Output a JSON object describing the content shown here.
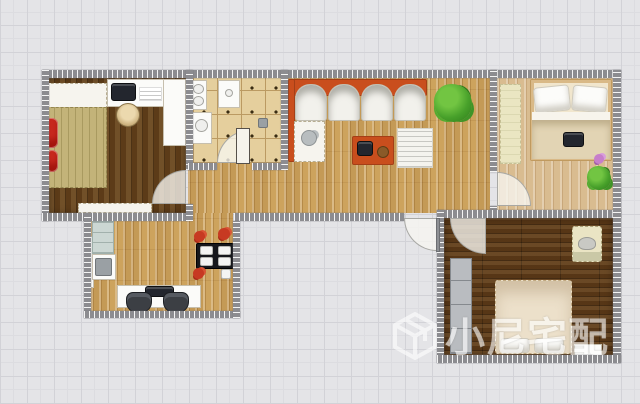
{
  "canvas": {
    "width": 640,
    "height": 404
  },
  "background": {
    "color": "#e4e4e7",
    "grid_color": "#d2d2d7",
    "grid_size_px": 27
  },
  "watermark": {
    "text": "小尼宅配",
    "logo": "cube-logo",
    "color": "#ffffff"
  },
  "colors": {
    "wall": "#8c8c90",
    "wood_floor_living": "#cda35d",
    "wood_floor_light_bedroom": "#d9bc90",
    "wood_floor_dark_bedroom": "#61401b",
    "bathroom_tile": "#e5cf9d",
    "sofa_accent_orange": "#c94e1d",
    "red_furniture": "#c8281e",
    "plant_green": "#47a02a"
  },
  "elements": [
    {
      "name": "bedroom-left-floor",
      "cls": "floor-dark-v",
      "r": [
        49,
        77,
        137,
        137
      ]
    },
    {
      "name": "living-room-floor",
      "cls": "floor-wood",
      "r": [
        188,
        77,
        302,
        136
      ]
    },
    {
      "name": "bathroom-floor",
      "cls": "floor-tile",
      "r": [
        193,
        77,
        88,
        86
      ]
    },
    {
      "name": "bedroom-right-floor",
      "cls": "floor-light-v",
      "r": [
        497,
        77,
        116,
        134
      ]
    },
    {
      "name": "dining-room-floor",
      "cls": "floor-wood",
      "r": [
        91,
        213,
        142,
        98
      ]
    },
    {
      "name": "bedroom-bottom-floor",
      "cls": "floor-dark-h",
      "r": [
        444,
        218,
        169,
        137
      ]
    },
    {
      "name": "left-bedroom-bedhead-mat",
      "cls": "white-stitch",
      "r": [
        46,
        83,
        61,
        26
      ]
    },
    {
      "name": "left-bedroom-bed",
      "cls": "bed-khaki",
      "r": [
        46,
        107,
        61,
        81
      ]
    },
    {
      "name": "left-bedroom-red-chair-1",
      "cls": "red-item",
      "r": [
        44,
        118,
        14,
        30
      ]
    },
    {
      "name": "left-bedroom-red-chair-2",
      "cls": "red-item",
      "r": [
        46,
        150,
        12,
        22
      ]
    },
    {
      "name": "left-bedroom-desk",
      "cls": "white-furn",
      "r": [
        107,
        79,
        58,
        28
      ]
    },
    {
      "name": "left-bedroom-computer",
      "cls": "dark-item",
      "r": [
        111,
        83,
        25,
        18
      ]
    },
    {
      "name": "left-bedroom-keyboard",
      "cls": "paper",
      "r": [
        139,
        87,
        23,
        14
      ]
    },
    {
      "name": "left-bedroom-wardrobe",
      "cls": "white-furn",
      "r": [
        163,
        79,
        23,
        67
      ]
    },
    {
      "name": "left-bedroom-stool",
      "cls": "stool",
      "r": [
        116,
        103,
        24,
        24
      ]
    },
    {
      "name": "left-bedroom-dresser",
      "cls": "white-stitch",
      "r": [
        78,
        203,
        74,
        10
      ]
    },
    {
      "name": "bathroom-vanity",
      "cls": "white-furn",
      "r": [
        191,
        80,
        16,
        30
      ]
    },
    {
      "name": "bathroom-vanity-bowl-1",
      "cls": "bowl",
      "r": [
        193,
        84,
        11,
        10
      ]
    },
    {
      "name": "bathroom-vanity-bowl-2",
      "cls": "bowl",
      "r": [
        193,
        96,
        11,
        10
      ]
    },
    {
      "name": "bathroom-shower-tray",
      "cls": "white-furn",
      "r": [
        218,
        80,
        22,
        28
      ]
    },
    {
      "name": "bathroom-shower-drain",
      "cls": "bowl",
      "r": [
        225,
        89,
        8,
        8
      ]
    },
    {
      "name": "bathroom-washer",
      "cls": "white-furn",
      "r": [
        191,
        112,
        21,
        32
      ]
    },
    {
      "name": "bathroom-washer-door",
      "cls": "bowl",
      "r": [
        195,
        119,
        13,
        13
      ]
    },
    {
      "name": "bathroom-floor-drain",
      "cls": "gray-item",
      "r": [
        258,
        118,
        10,
        10
      ]
    },
    {
      "name": "sofa-back",
      "cls": "orange-item",
      "r": [
        289,
        79,
        138,
        17
      ]
    },
    {
      "name": "sofa-arm",
      "cls": "orange-item",
      "r": [
        288,
        79,
        7,
        83
      ]
    },
    {
      "name": "sofa-seat-1",
      "cls": "sofa-seat",
      "r": [
        295,
        84,
        32,
        37
      ]
    },
    {
      "name": "sofa-seat-2",
      "cls": "sofa-seat",
      "r": [
        328,
        84,
        32,
        37
      ]
    },
    {
      "name": "sofa-seat-3",
      "cls": "sofa-seat",
      "r": [
        361,
        84,
        32,
        37
      ]
    },
    {
      "name": "sofa-seat-4",
      "cls": "sofa-seat",
      "r": [
        394,
        84,
        32,
        37
      ]
    },
    {
      "name": "sofa-chaise",
      "cls": "white-stitch",
      "r": [
        294,
        121,
        31,
        41
      ]
    },
    {
      "name": "sofa-teapot",
      "cls": "teapot",
      "r": [
        301,
        130,
        16,
        16
      ]
    },
    {
      "name": "coffee-table",
      "cls": "orange-item",
      "r": [
        352,
        136,
        42,
        29
      ]
    },
    {
      "name": "coffee-table-kettle",
      "cls": "dark-item",
      "r": [
        357,
        141,
        16,
        15
      ]
    },
    {
      "name": "coffee-table-bowl",
      "cls": "brown-item",
      "r": [
        377,
        146,
        12,
        12
      ]
    },
    {
      "name": "living-rug",
      "cls": "rug-striped",
      "r": [
        397,
        128,
        36,
        40
      ]
    },
    {
      "name": "living-plant",
      "cls": "plant",
      "r": [
        434,
        84,
        38,
        38
      ]
    },
    {
      "name": "right-bedroom-mat",
      "cls": "mat-pale",
      "r": [
        500,
        84,
        21,
        80
      ]
    },
    {
      "name": "right-bedroom-bed",
      "cls": "bed-frame",
      "r": [
        530,
        79,
        82,
        82
      ]
    },
    {
      "name": "right-bedroom-pillow-1",
      "cls": "pillow",
      "r": [
        534,
        86,
        36,
        26
      ],
      "rot": -6
    },
    {
      "name": "right-bedroom-pillow-2",
      "cls": "pillow",
      "r": [
        572,
        86,
        35,
        26
      ],
      "rot": 5
    },
    {
      "name": "right-bedroom-sheet",
      "cls": "sheet",
      "r": [
        532,
        112,
        78,
        8
      ]
    },
    {
      "name": "right-bedroom-blanket",
      "cls": "blanket",
      "r": [
        532,
        120,
        78,
        39
      ]
    },
    {
      "name": "right-bedroom-tray",
      "cls": "dark-item",
      "r": [
        563,
        132,
        21,
        15
      ]
    },
    {
      "name": "right-bedroom-flower",
      "cls": "flower-pink",
      "r": [
        594,
        154,
        10,
        10
      ]
    },
    {
      "name": "right-bedroom-plant",
      "cls": "plant",
      "r": [
        587,
        166,
        24,
        24
      ]
    },
    {
      "name": "dining-radiator",
      "cls": "white-furn",
      "r": [
        86,
        236,
        8,
        52
      ]
    },
    {
      "name": "dining-cabinet",
      "cls": "cabinet-blue",
      "r": [
        92,
        221,
        22,
        33
      ]
    },
    {
      "name": "dining-unit",
      "cls": "white-furn",
      "r": [
        92,
        254,
        24,
        26
      ]
    },
    {
      "name": "dining-unit-panel",
      "cls": "gray-item",
      "r": [
        95,
        258,
        17,
        18
      ]
    },
    {
      "name": "dining-desk",
      "cls": "white-furn",
      "r": [
        117,
        285,
        84,
        23
      ]
    },
    {
      "name": "dining-monitor",
      "cls": "dark-item",
      "r": [
        145,
        286,
        29,
        11
      ]
    },
    {
      "name": "dining-chair-1",
      "cls": "office-chair",
      "r": [
        126,
        292,
        26,
        21
      ]
    },
    {
      "name": "dining-chair-2",
      "cls": "office-chair",
      "r": [
        163,
        292,
        26,
        21
      ]
    },
    {
      "name": "dining-table",
      "cls": "dark-table",
      "r": [
        196,
        243,
        38,
        26
      ]
    },
    {
      "name": "dining-plate-1",
      "cls": "plate",
      "r": [
        200,
        246,
        13,
        9
      ]
    },
    {
      "name": "dining-plate-2",
      "cls": "plate",
      "r": [
        218,
        246,
        13,
        9
      ]
    },
    {
      "name": "dining-plate-3",
      "cls": "plate",
      "r": [
        200,
        257,
        13,
        9
      ]
    },
    {
      "name": "dining-plate-4",
      "cls": "plate",
      "r": [
        218,
        257,
        13,
        9
      ]
    },
    {
      "name": "dining-flower-1",
      "cls": "flower-red",
      "r": [
        194,
        231,
        11,
        11
      ]
    },
    {
      "name": "dining-flower-2",
      "cls": "flower-red",
      "r": [
        218,
        228,
        12,
        12
      ]
    },
    {
      "name": "dining-flower-3",
      "cls": "flower-red",
      "r": [
        193,
        268,
        11,
        11
      ]
    },
    {
      "name": "dining-cup",
      "cls": "plate",
      "r": [
        221,
        269,
        10,
        10
      ]
    },
    {
      "name": "bottom-bedroom-wardrobe",
      "cls": "wardrobe-gray",
      "r": [
        450,
        258,
        22,
        96
      ]
    },
    {
      "name": "bottom-bedroom-bed",
      "cls": "bed-cream",
      "r": [
        495,
        280,
        77,
        74
      ]
    },
    {
      "name": "bottom-bedroom-pillow-1",
      "cls": "pillow",
      "r": [
        500,
        338,
        30,
        15
      ]
    },
    {
      "name": "bottom-bedroom-pillow-2",
      "cls": "pillow",
      "r": [
        534,
        338,
        30,
        15
      ]
    },
    {
      "name": "bottom-bedroom-armchair",
      "cls": "armchair",
      "r": [
        572,
        226,
        30,
        36
      ]
    },
    {
      "name": "bottom-bedroom-armchair-seat",
      "cls": "seat-glyph",
      "r": [
        578,
        237,
        18,
        13
      ]
    },
    {
      "name": "bottom-bedroom-nightstand",
      "cls": "white-furn",
      "r": [
        574,
        344,
        28,
        12
      ]
    },
    {
      "name": "wall-top",
      "cls": "wall-h",
      "r": [
        42,
        70,
        579,
        8
      ]
    },
    {
      "name": "wall-left",
      "cls": "wall-v",
      "r": [
        42,
        70,
        7,
        151
      ]
    },
    {
      "name": "wall-left-bedroom-bottom",
      "cls": "wall-h",
      "r": [
        42,
        213,
        146,
        8
      ]
    },
    {
      "name": "wall-left-bedroom-right-upper",
      "cls": "wall-v",
      "r": [
        186,
        70,
        7,
        100
      ]
    },
    {
      "name": "wall-left-bedroom-right-lower",
      "cls": "wall-v",
      "r": [
        186,
        204,
        7,
        17
      ]
    },
    {
      "name": "wall-bathroom-right",
      "cls": "wall-v",
      "r": [
        281,
        70,
        7,
        100
      ]
    },
    {
      "name": "wall-bathroom-bottom-left",
      "cls": "wall-h",
      "r": [
        188,
        163,
        29,
        7
      ]
    },
    {
      "name": "wall-bathroom-bottom-right",
      "cls": "wall-h",
      "r": [
        252,
        163,
        29,
        7
      ]
    },
    {
      "name": "wall-living-bottom",
      "cls": "wall-h",
      "r": [
        234,
        213,
        170,
        8
      ]
    },
    {
      "name": "wall-living-right",
      "cls": "wall-v",
      "r": [
        490,
        70,
        7,
        102
      ]
    },
    {
      "name": "wall-living-right-stub",
      "cls": "wall-v",
      "r": [
        490,
        206,
        7,
        12
      ]
    },
    {
      "name": "wall-bedrooms-divider",
      "cls": "wall-h",
      "r": [
        437,
        210,
        184,
        8
      ]
    },
    {
      "name": "wall-bottom-bedroom-left",
      "cls": "wall-v",
      "r": [
        437,
        210,
        7,
        153
      ]
    },
    {
      "name": "wall-right",
      "cls": "wall-v",
      "r": [
        613,
        70,
        8,
        293
      ]
    },
    {
      "name": "wall-bottom-bedroom-bottom",
      "cls": "wall-h",
      "r": [
        437,
        355,
        184,
        8
      ]
    },
    {
      "name": "wall-dining-left",
      "cls": "wall-v",
      "r": [
        84,
        213,
        7,
        105
      ]
    },
    {
      "name": "wall-dining-bottom",
      "cls": "wall-h",
      "r": [
        84,
        311,
        156,
        7
      ]
    },
    {
      "name": "wall-dining-right",
      "cls": "wall-v",
      "r": [
        233,
        221,
        7,
        97
      ]
    },
    {
      "name": "left-bedroom-door-swing",
      "cls": "arc arc-tl",
      "r": [
        152,
        170,
        34,
        34
      ]
    },
    {
      "name": "bathroom-door-swing",
      "cls": "arc arc-tl",
      "r": [
        217,
        130,
        33,
        33
      ]
    },
    {
      "name": "bathroom-door-leaf",
      "cls": "door-leaf",
      "r": [
        236,
        128,
        14,
        36
      ]
    },
    {
      "name": "right-bedroom-door-swing",
      "cls": "arc arc-tr",
      "r": [
        497,
        172,
        34,
        34
      ]
    },
    {
      "name": "entry-door-swing",
      "cls": "arc arc-bl",
      "r": [
        404,
        218,
        33,
        33
      ]
    },
    {
      "name": "entry-door-leaf",
      "cls": "door-leaf-dark",
      "r": [
        436,
        218,
        4,
        34
      ]
    },
    {
      "name": "bottom-bedroom-door-swing",
      "cls": "arc arc-bl",
      "r": [
        450,
        218,
        36,
        36
      ]
    }
  ]
}
